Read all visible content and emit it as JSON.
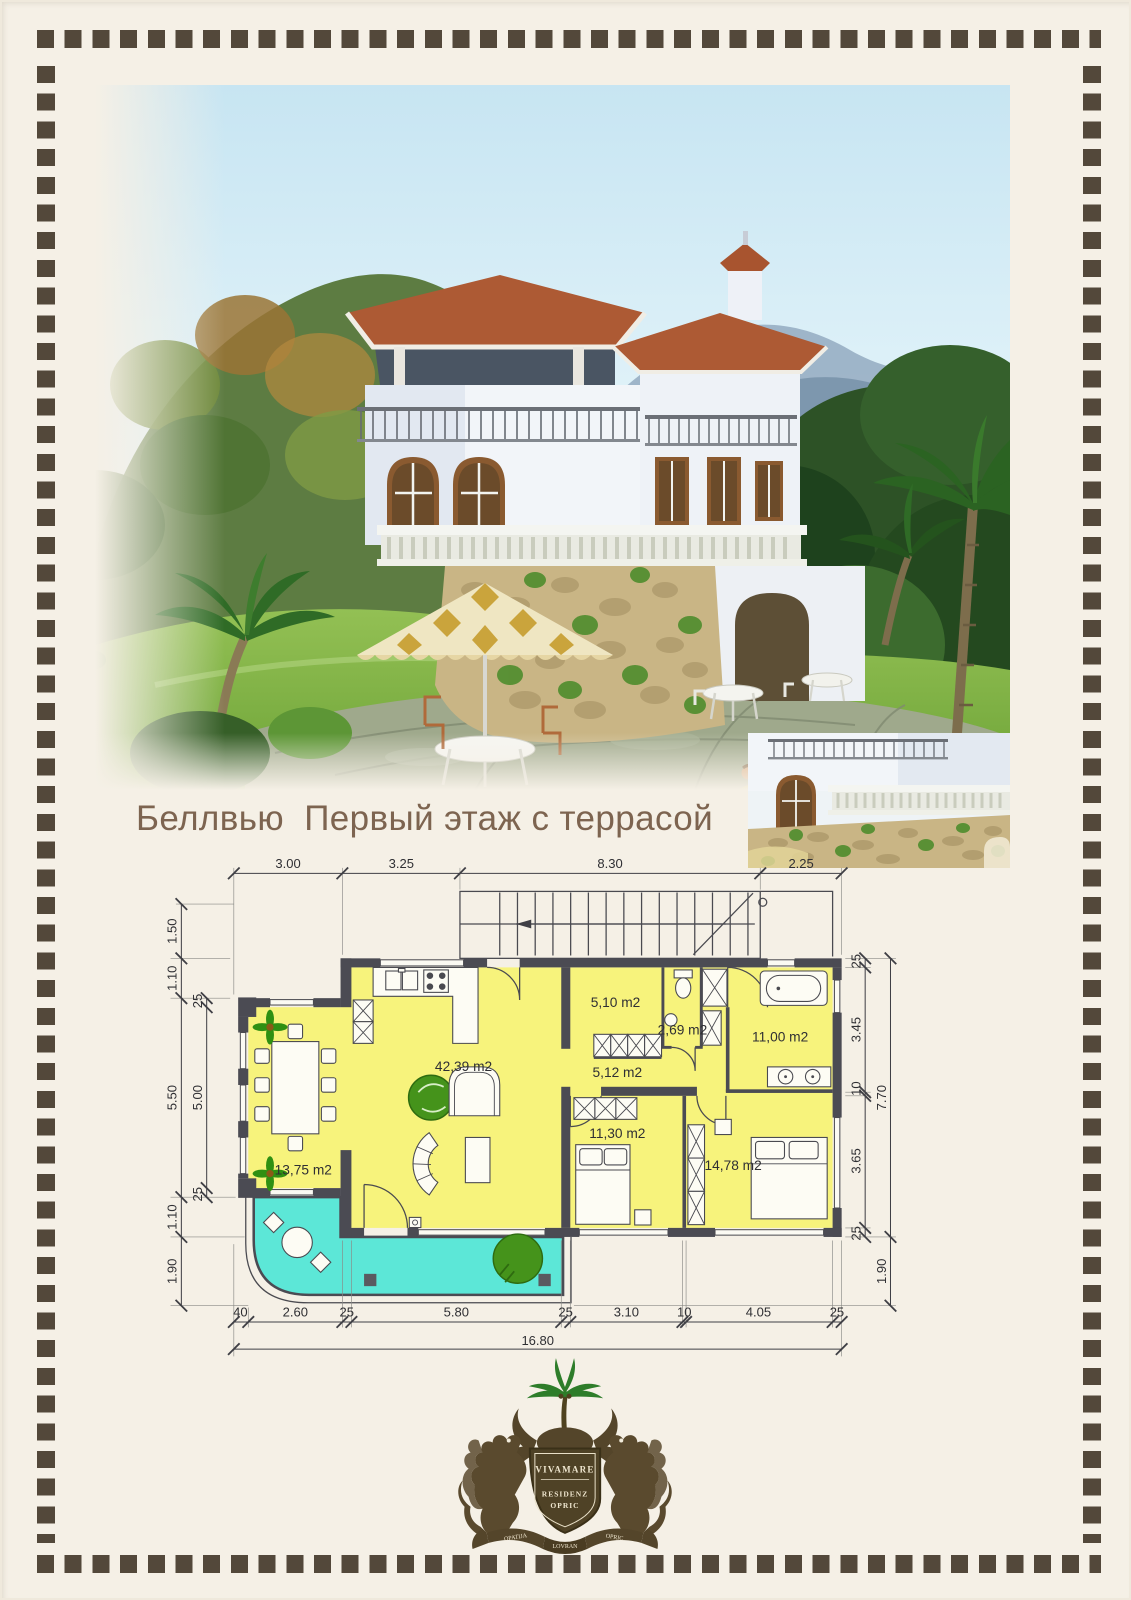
{
  "page": {
    "title": "Беллвью  Первый этаж с террасой"
  },
  "colors": {
    "page_background": "#f5f0e6",
    "border_square": "#53483a",
    "title_text": "#7d6450",
    "room_fill": "#f7f37c",
    "terrace_fill": "#5ce7d7",
    "wall": "#4b4b53",
    "plant_green": "#45931b"
  },
  "floor_plan": {
    "rooms": [
      {
        "id": "living-room",
        "area": "42,39 m2"
      },
      {
        "id": "dining-bay",
        "area": "13,75 m2"
      },
      {
        "id": "storage-room",
        "area": "5,10 m2"
      },
      {
        "id": "wc",
        "area": "2,69 m2"
      },
      {
        "id": "bathroom",
        "area": "11,00 m2"
      },
      {
        "id": "hallway",
        "area": "5,12 m2"
      },
      {
        "id": "bedroom-1",
        "area": "11,30 m2"
      },
      {
        "id": "bedroom-2",
        "area": "14,78 m2"
      }
    ],
    "dims_top": [
      "3.00",
      "3.25",
      "8.30",
      "2.25"
    ],
    "dims_bottom": [
      "40",
      "2.60",
      "25",
      "5.80",
      "25",
      "3.10",
      "10",
      "4.05",
      "25"
    ],
    "dims_bottom_total": "16.80",
    "dims_left_outer": [
      "1.50",
      "1.10",
      "5.50",
      "1.10",
      "1.90"
    ],
    "dims_left_inner": [
      "25",
      "5.00",
      "25"
    ],
    "dims_right_inner": [
      "25",
      "3.45",
      "10",
      "3.65",
      "25"
    ],
    "dims_right_outer": [
      "7.70",
      "1.90"
    ]
  },
  "logo": {
    "shield_line1": "VIVAMARE",
    "shield_line2": "RESIDENZ",
    "shield_line3": "OPRIC",
    "banner_left": "OPATIJA",
    "banner_center": "LOVRAN",
    "banner_right": "OPRIC"
  }
}
